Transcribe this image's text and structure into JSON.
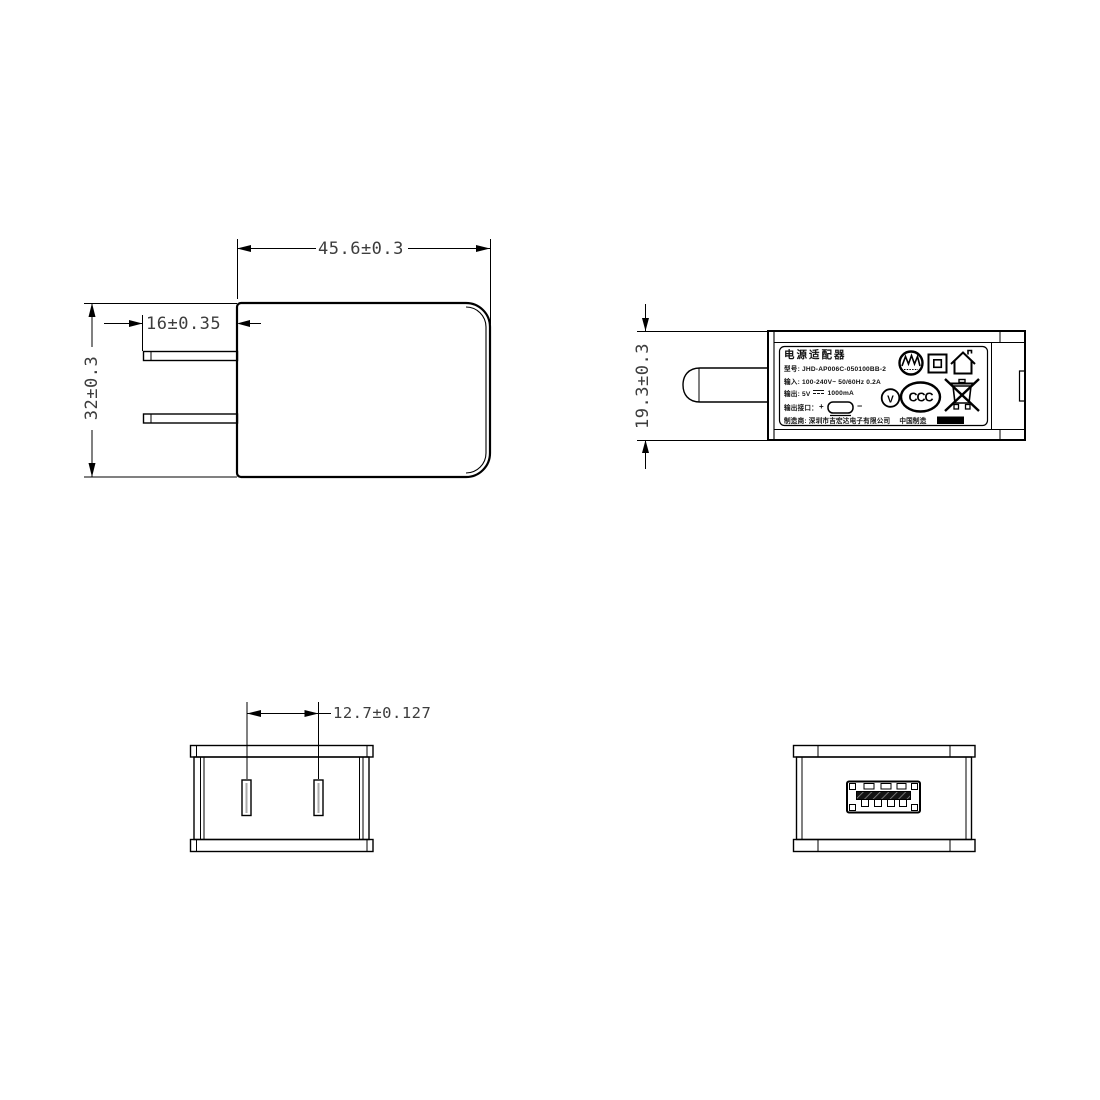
{
  "page": {
    "background": "#ffffff",
    "line_color": "#000000",
    "dim_text_color": "#3d3d3d"
  },
  "front_view": {
    "dim_width": "45.6±0.3",
    "dim_prong_length": "16±0.35",
    "dim_height": "32±0.3"
  },
  "side_view": {
    "dim_thickness": "19.3±0.3",
    "label": {
      "title": "电源适配器",
      "model_line": "型号: JHD-AP006C-050100BB-2",
      "input_line": "输入: 100-240V~  50/60Hz  0.2A",
      "output_prefix": "输出: 5V",
      "output_suffix": "1000mA",
      "port_label": "输出接口：",
      "plus_sign": "+",
      "minus_sign": "−",
      "manufacturer": "制造商: 深圳市吉宏达电子有限公司",
      "made_in": "中国制造",
      "efficiency_letter": "V",
      "ccc_text": "CCC"
    }
  },
  "bottom_view": {
    "dim_prong_pitch": "12.7±0.127"
  }
}
